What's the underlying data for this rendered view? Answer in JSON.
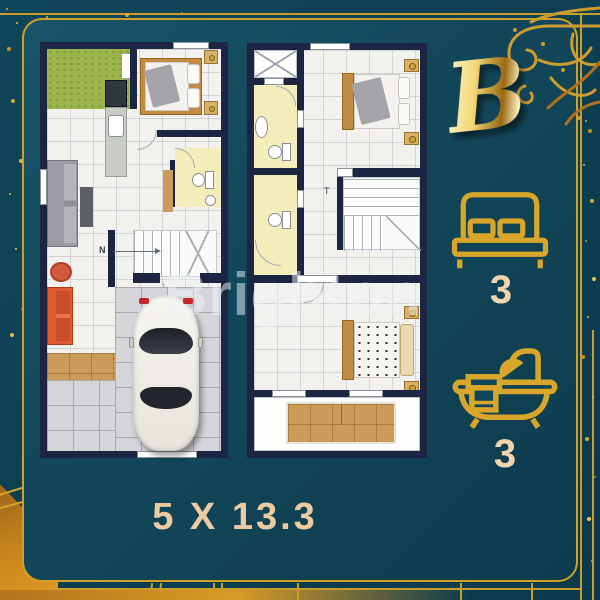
{
  "unit": {
    "label": "B"
  },
  "specs": {
    "bedrooms": {
      "icon": "bed-icon",
      "count": "3"
    },
    "bathrooms": {
      "icon": "bathtub-icon",
      "count": "3"
    }
  },
  "dimensions": {
    "text": "5 X 13.3"
  },
  "watermark": {
    "text": "Brighton"
  },
  "plans": {
    "ground": {
      "north_label": "N"
    },
    "upper": {
      "stair_label": "T"
    }
  },
  "colors": {
    "background_teal": "#0e4052",
    "gold": "#cfa12b",
    "wall_navy": "#1c2542",
    "cream_text": "#eccaa2",
    "bathroom_yellow": "#f3edbc",
    "garden_green": "#9cb44a",
    "wood_tan": "#cc9a59",
    "sofa_orange": "#e05a2e",
    "floor_white": "#f2f1ed"
  }
}
